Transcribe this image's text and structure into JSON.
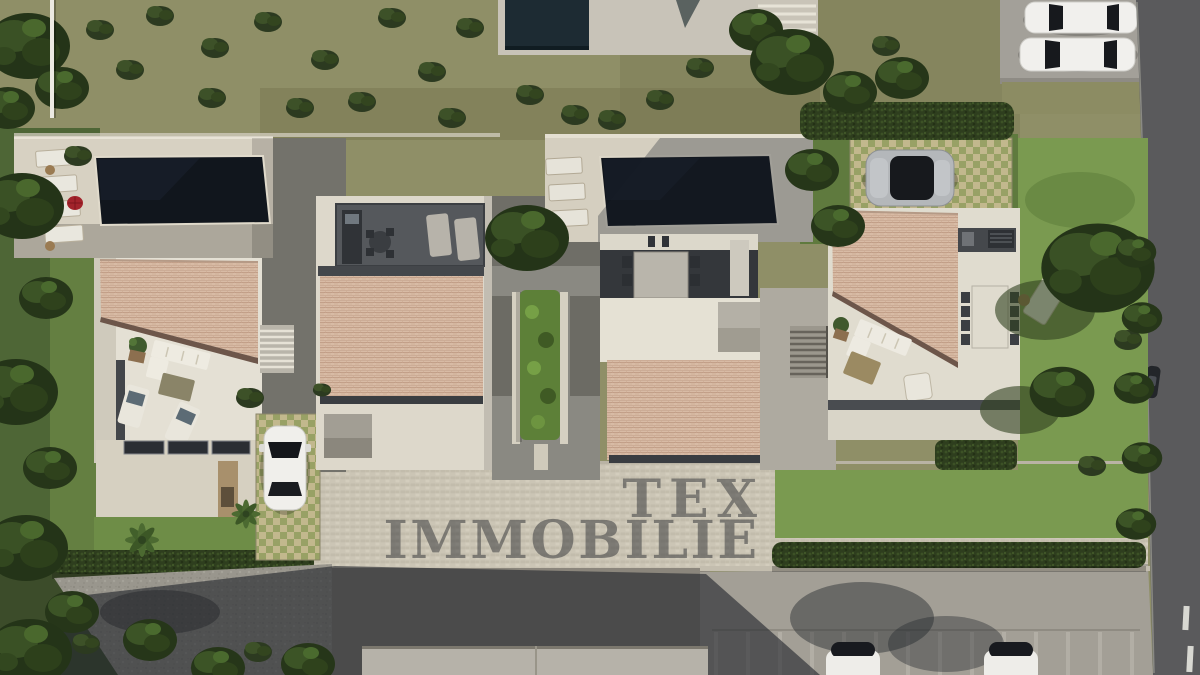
{
  "watermark": {
    "line1": "TEX",
    "line2": "IMMOBILIE"
  },
  "scene": {
    "type": "aerial-3d-architectural-rendering",
    "description": "Top-down 3D visualisation of a new-build development: two modern villas, each with a dark rectangular pool on a light stone sun deck, clay-tiled hip roofs over white flat-roof volumes, street-side annex buildings, a central paved courtyard with a linear hedge planter, landscaped gardens, parked cars, a cobbled lane and an asphalt road.",
    "site": {
      "left_villa": {
        "pool": "dark rectangular pool",
        "sun_loungers": 4,
        "umbrella_color": "red",
        "terrace": "L-shaped lounge sofa, coffee table, two chaise longues, potted plant",
        "car": "white car on grass-paver carport",
        "extras": [
          "external stair",
          "skylight strips on lower flat roof",
          "palm trees",
          "gravel drive"
        ]
      },
      "right_villa": {
        "pool": "dark rectangular pool",
        "sun_loungers": 3,
        "terrace": "L-shaped lounge sofa, wooden coffee table, armchair, outdoor dining table with 8 chairs, outdoor kitchen",
        "car": "silver car on grass-paver driveway",
        "extras": [
          "covered dining loggia with long table",
          "garden sun bed",
          "external stair"
        ]
      },
      "annex_buildings": 2,
      "central_courtyard": "paved court with long hedge planter between stone curbs",
      "neighbour_plot_top": "flat-roof building with dark pool and slatted pergola",
      "parked_cars_top_right": 2,
      "parked_cars_bottom_right": 2,
      "scooter_on_road": 1,
      "roads": [
        "asphalt road along right edge with dashed centre line",
        "cobbled lane across the bottom",
        "gravel drive bottom left",
        "parking court with marked stalls bottom right"
      ]
    }
  },
  "colors": {
    "pool_water": "#11161d",
    "roof_tiles": "#d8bba5",
    "deck_paving": "#d7d1c2",
    "white_building": "#e6e2d5",
    "field_olive": "#8f8f67",
    "lawn_green": "#7a9a50",
    "tree_dark_green": "#2c3a20",
    "asphalt": "#5a5a5c",
    "cobble": "#cbc5b5",
    "building_shadow": "#24272d",
    "car_white": "#f0efeb",
    "car_silver": "#b4b7ba",
    "umbrella_red": "#a2232b",
    "watermark_gray": "rgba(45,47,52,0.5)"
  }
}
